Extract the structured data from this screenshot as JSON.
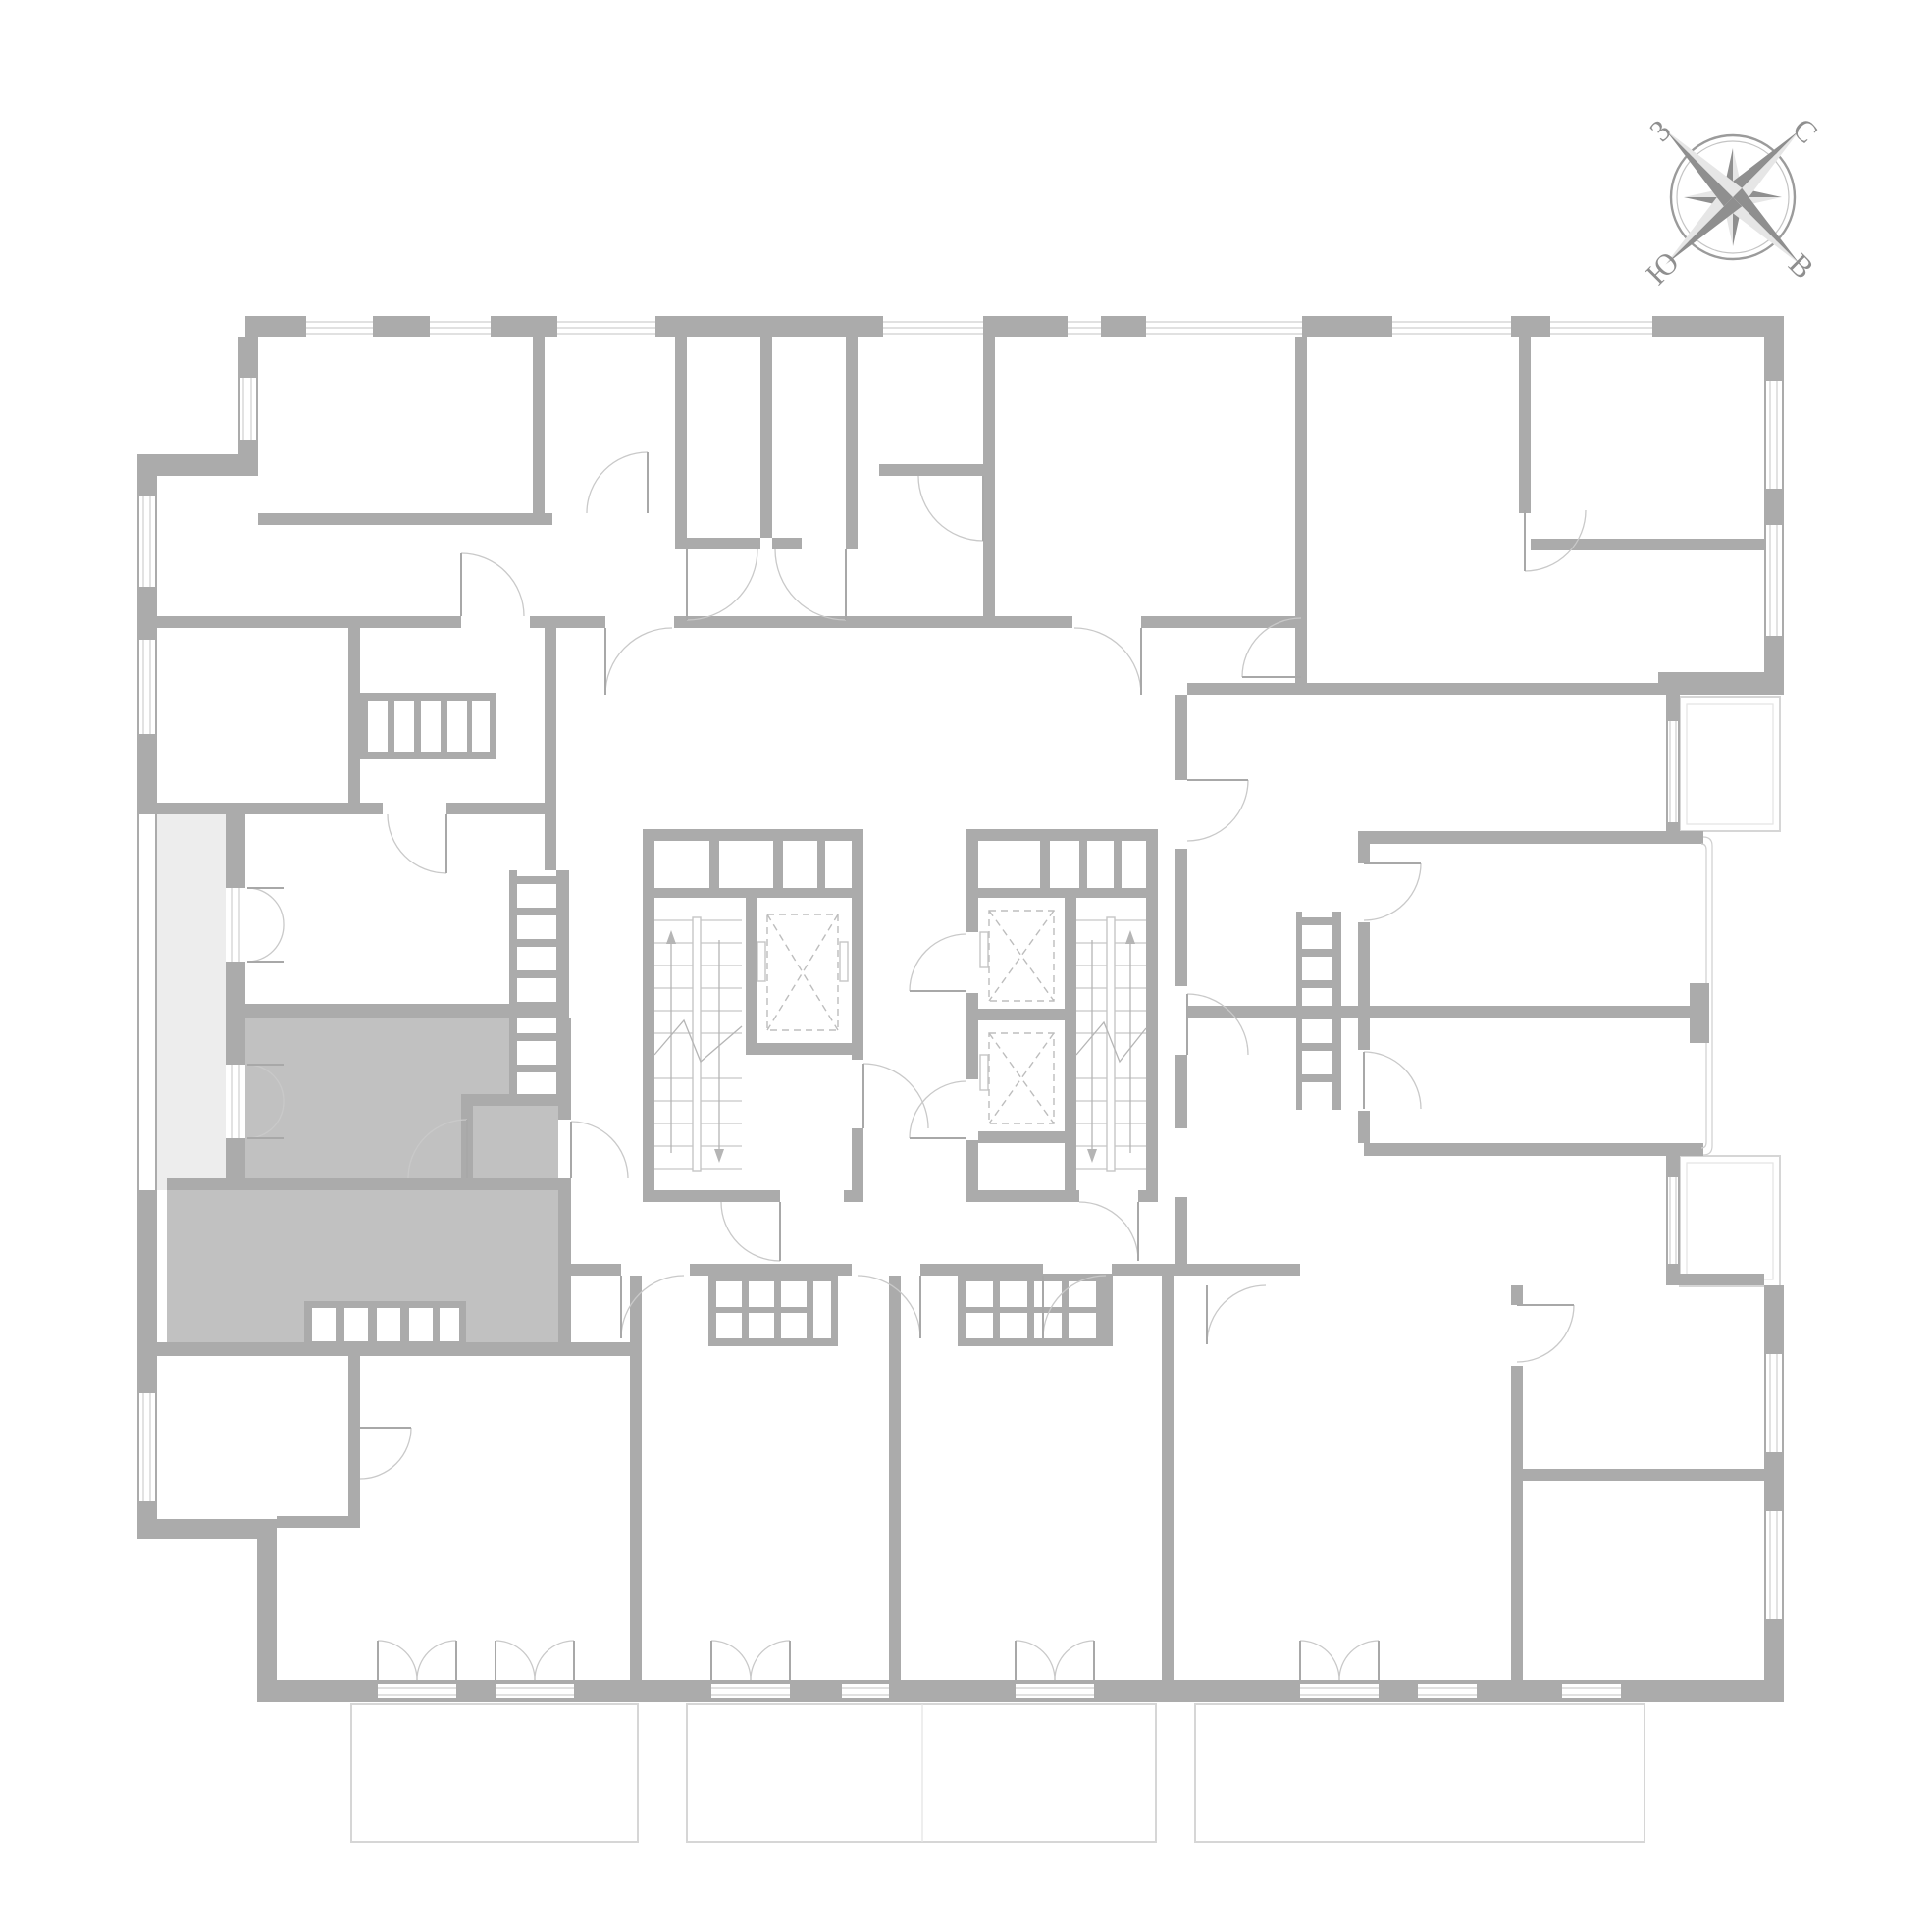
{
  "compass": {
    "north": "С",
    "east": "В",
    "south": "Ю",
    "west": "З"
  },
  "palette": {
    "wall": "#ababab",
    "wall-thin": "#c6c6c6",
    "glass": "#cfcfcf",
    "door": "#c9c9c9",
    "highlight": "#c1c1c1",
    "loggia": "#ededed",
    "balcony": "#d6d6d6",
    "compass-dark": "#8f8f8f",
    "compass-light": "#e6e6e6",
    "compass-label": "#8f8f8f",
    "bg": "#ffffff"
  },
  "floor_plan": {
    "highlighted_unit": {
      "name": "highlighted-apartment",
      "fill": "#c1c1c1"
    }
  }
}
